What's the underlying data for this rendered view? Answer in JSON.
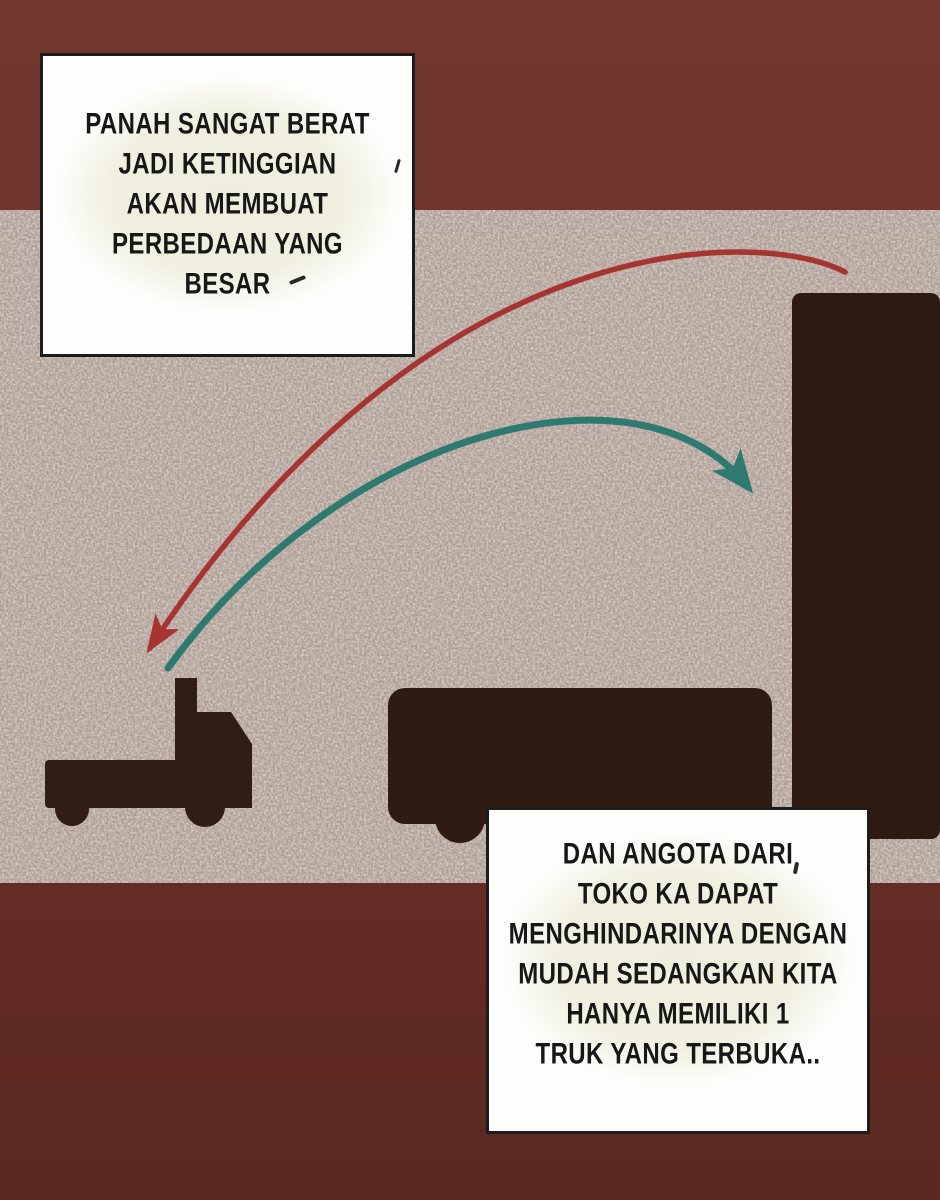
{
  "page": {
    "kind": "comic-panel",
    "background_top_color": "#71362e",
    "background_bottom_color": "#5d2822"
  },
  "panel": {
    "texture_base_color": "#ab9b93",
    "silhouette_color": "#2e1b12",
    "silhouettes": [
      {
        "name": "flatbed-truck",
        "position": "bottom-left"
      },
      {
        "name": "box-truck",
        "position": "bottom-middle"
      },
      {
        "name": "large-truck-box",
        "position": "right-edge"
      }
    ],
    "arrows": {
      "red": {
        "color": "#a63430",
        "shape": "high arc ending at left truck"
      },
      "teal": {
        "color": "#2f7a70",
        "shape": "lower arc ending at right truck box"
      }
    }
  },
  "bubbles": {
    "top_left": {
      "lines": [
        "PANAH SANGAT BERAT",
        "JADI KETINGGIAN",
        "AKAN MEMBUAT",
        "PERBEDAAN YANG",
        "BESAR"
      ]
    },
    "bottom_right": {
      "lines": [
        "DAN ANGOTA DARI",
        "TOKO KA DAPAT",
        "MENGHINDARINYA DENGAN",
        "MUDAH SEDANGKAN KITA",
        "HANYA MEMILIKI 1",
        "TRUK YANG TERBUKA.."
      ]
    }
  }
}
